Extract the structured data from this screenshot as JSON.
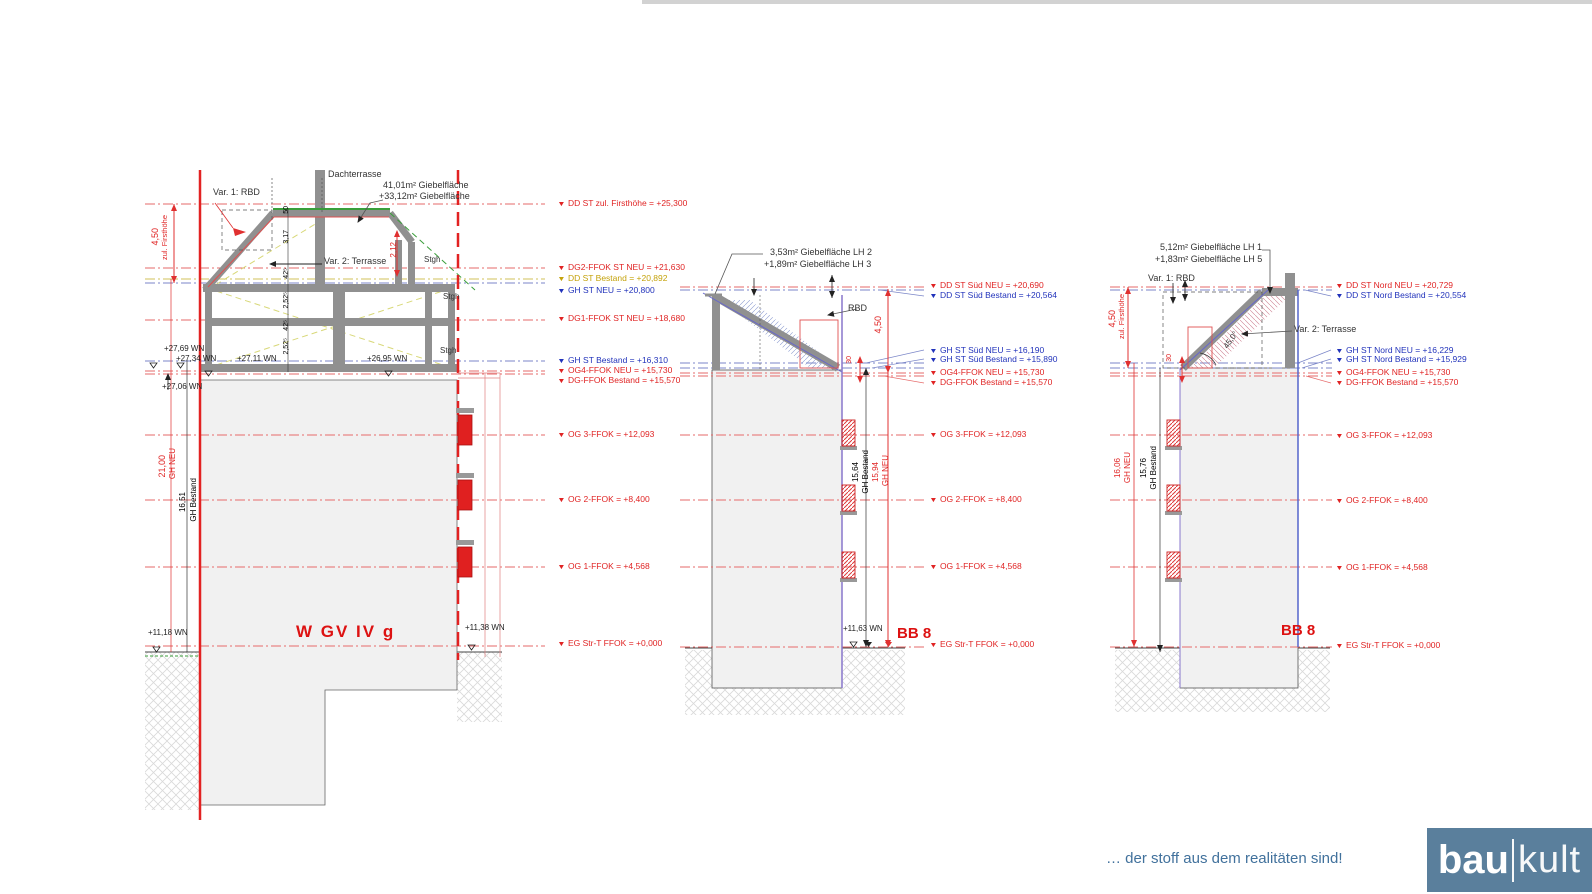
{
  "footer": {
    "tagline": "… der stoff aus dem realitäten sind!",
    "logo": {
      "bau": "bau",
      "kult": "kult"
    }
  },
  "left_section": {
    "title": "W GV IV  g",
    "annotations": {
      "var1": "Var. 1: RBD",
      "dachterrasse": "Dachterrasse",
      "giebel1": "41,01m²  Giebelfläche",
      "giebel2": "+33,12m²  Giebelfläche",
      "var2": "Var. 2: Terrasse",
      "stgh1": "Stgh",
      "stgh2": "Stgh",
      "stgh3": "Stgh"
    },
    "dims": {
      "firsthoehe_val": "4,50",
      "firsthoehe_lbl": "zul. Firsthöhe",
      "chain": [
        "50",
        "3,17",
        "42⁵",
        "2,52⁵",
        "42⁵",
        "2,52⁵"
      ],
      "d212": "2,12",
      "gh_neu_val": "21,00",
      "gh_neu_lbl": "GH NEU",
      "gh_best_val": "16,51",
      "gh_best_lbl": "GH Bestand"
    },
    "wn": {
      "w2769": "+27,69 WN",
      "w2734": "+27,34 WN",
      "w2711": "+27,11 WN",
      "w2695": "+26,95 WN",
      "w2706": "+27,06 WN",
      "w1118": "+11,18 WN",
      "w1138": "+11,38 WN"
    },
    "levels": [
      {
        "text": "DD ST zul. Firsthöhe  =  +25,300",
        "color": "red"
      },
      {
        "text": "DG2-FFOK ST NEU  =  +21,630",
        "color": "red"
      },
      {
        "text": "DD ST Bestand  =  +20,892",
        "color": "yellow"
      },
      {
        "text": "GH ST NEU  =  +20,800",
        "color": "blue"
      },
      {
        "text": "DG1-FFOK ST NEU  =  +18,680",
        "color": "red"
      },
      {
        "text": "GH ST Bestand  =  +16,310",
        "color": "blue"
      },
      {
        "text": "OG4-FFOK NEU  =  +15,730",
        "color": "red"
      },
      {
        "text": "DG-FFOK Bestand  =  +15,570",
        "color": "red"
      },
      {
        "text": "OG 3-FFOK  =  +12,093",
        "color": "red"
      },
      {
        "text": "OG 2-FFOK  =  +8,400",
        "color": "red"
      },
      {
        "text": "OG 1-FFOK  =  +4,568",
        "color": "red"
      },
      {
        "text": "EG Str-T FFOK  =  +0,000",
        "color": "red"
      }
    ]
  },
  "south_section": {
    "bb": "BB 8",
    "annotations": {
      "giebel1": "3,53m²  Giebelfläche LH 2",
      "giebel2": "+1,89m²  Giebelfläche LH 3",
      "rbd": "RBD"
    },
    "dims": {
      "d450": "4,50",
      "d30": "30",
      "gh_best_val": "15,64",
      "gh_best_lbl": "GH Bestand",
      "gh_neu_val": "15,94",
      "gh_neu_lbl": "GH NEU"
    },
    "wn": {
      "w1163": "+11,63 WN"
    },
    "levels": [
      {
        "text": "DD ST Süd NEU  =  +20,690",
        "color": "red"
      },
      {
        "text": "DD ST Süd Bestand  =  +20,564",
        "color": "blue"
      },
      {
        "text": "GH ST Süd NEU  =  +16,190",
        "color": "blue"
      },
      {
        "text": "GH ST Süd Bestand  =  +15,890",
        "color": "blue"
      },
      {
        "text": "OG4-FFOK NEU  =  +15,730",
        "color": "red"
      },
      {
        "text": "DG-FFOK Bestand  =  +15,570",
        "color": "red"
      },
      {
        "text": "OG 3-FFOK  =  +12,093",
        "color": "red"
      },
      {
        "text": "OG 2-FFOK  =  +8,400",
        "color": "red"
      },
      {
        "text": "OG 1-FFOK  =  +4,568",
        "color": "red"
      },
      {
        "text": "EG Str-T FFOK  =  +0,000",
        "color": "red"
      }
    ]
  },
  "north_section": {
    "bb": "BB 8",
    "annotations": {
      "giebel1": "5,12m²  Giebelfläche LH 1",
      "giebel2": "+1,83m²  Giebelfläche LH 5",
      "var1": "Var. 1: RBD",
      "var2": "Var. 2: Terrasse",
      "angle": "45,0°"
    },
    "dims": {
      "d450": "4,50",
      "firsthoehe_lbl": "zul. Firsthöhe",
      "d30": "30",
      "gh_neu_val": "16,06",
      "gh_neu_lbl": "GH NEU",
      "gh_best_val": "15,76",
      "gh_best_lbl": "GH Bestand"
    },
    "levels": [
      {
        "text": "DD ST Nord NEU  =  +20,729",
        "color": "red"
      },
      {
        "text": "DD ST Nord Bestand  =  +20,554",
        "color": "blue"
      },
      {
        "text": "GH ST Nord NEU  =  +16,229",
        "color": "blue"
      },
      {
        "text": "GH ST Nord Bestand  =  +15,929",
        "color": "blue"
      },
      {
        "text": "OG4-FFOK NEU  =  +15,730",
        "color": "red"
      },
      {
        "text": "DG-FFOK Bestand  =  +15,570",
        "color": "red"
      },
      {
        "text": "OG 3-FFOK  =  +12,093",
        "color": "red"
      },
      {
        "text": "OG 2-FFOK  =  +8,400",
        "color": "red"
      },
      {
        "text": "OG 1-FFOK  =  +4,568",
        "color": "red"
      },
      {
        "text": "EG Str-T FFOK  =  +0,000",
        "color": "red"
      }
    ]
  }
}
